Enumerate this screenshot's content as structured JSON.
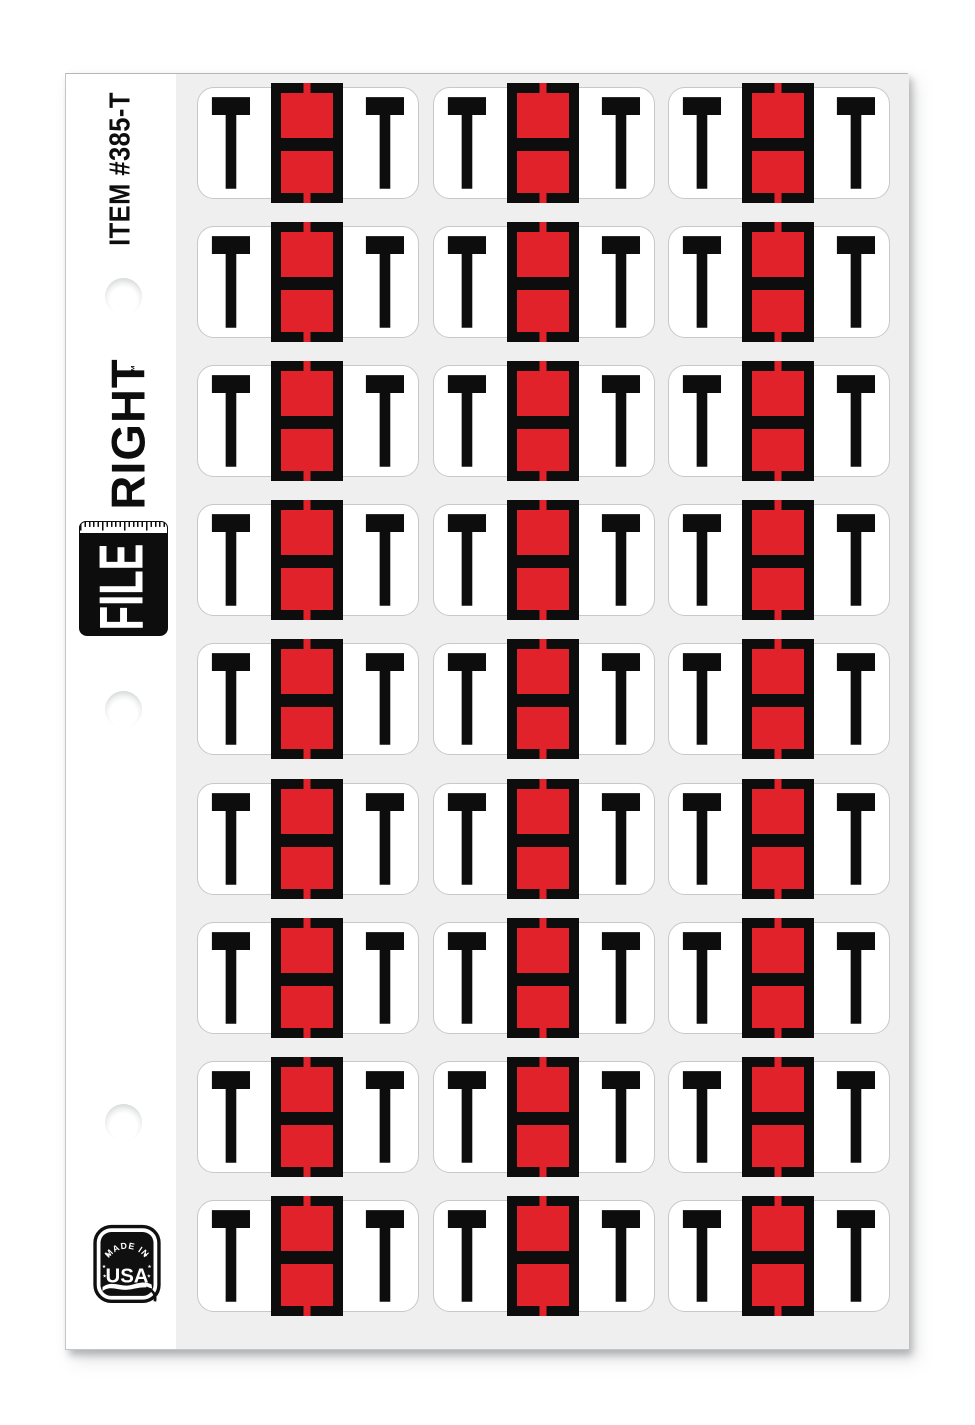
{
  "sheet": {
    "item_number": "ITEM #385-T",
    "brand": {
      "file": "FILE",
      "right": "RIGHT",
      "tm": "™"
    },
    "badge": {
      "arc_text": "MADE IN",
      "main_text": "USA"
    },
    "letter": "T",
    "grid": {
      "rows": 9,
      "columns": 3
    },
    "colors": {
      "label_red": "#e1222a",
      "label_black": "#0d0d0d",
      "sheet_gray": "#efefef",
      "label_border": "#c6c8ca",
      "page_white": "#ffffff"
    }
  }
}
